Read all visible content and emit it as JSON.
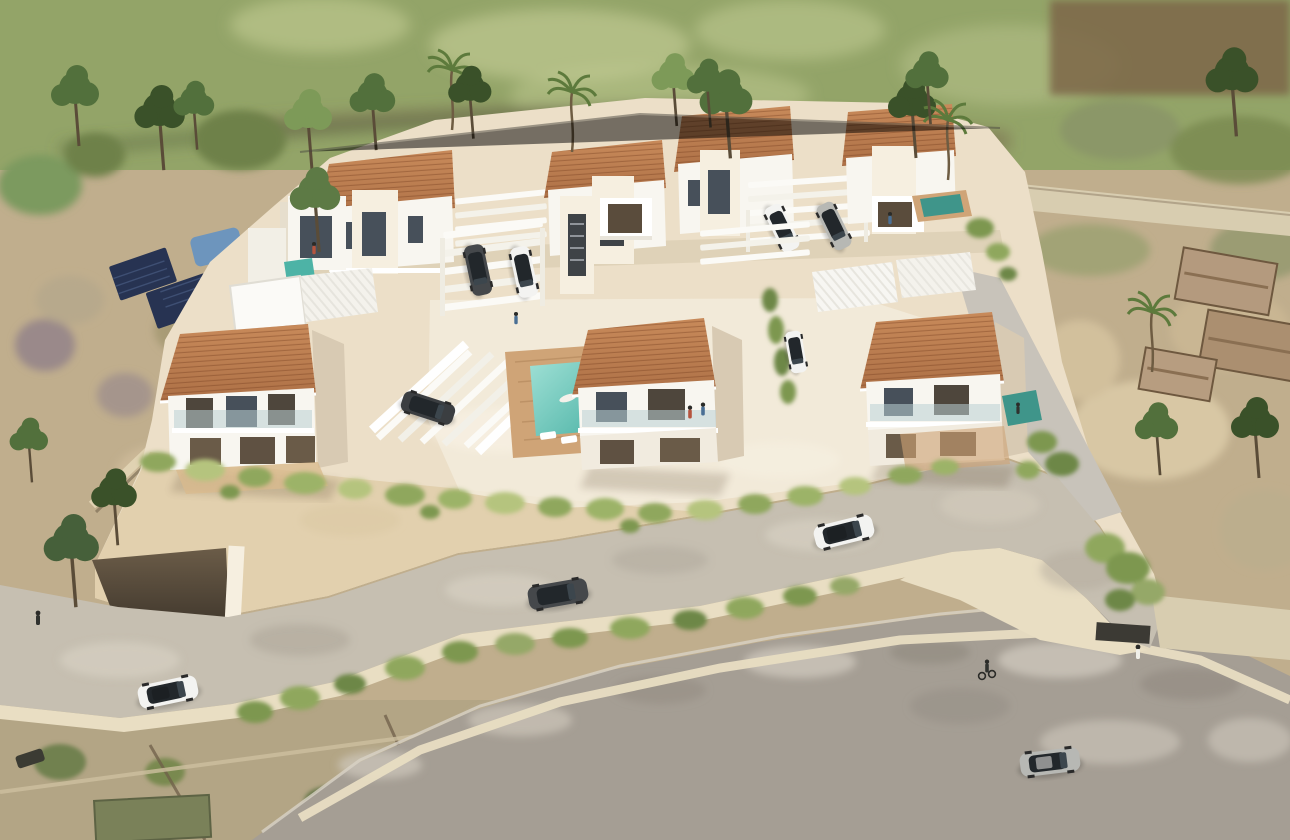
{
  "scene": {
    "title": "Aerial 3D architectural render of a gated villa development",
    "setting": "hillside plot bordered by trees, an access road and aerial-photo countryside",
    "view": "high-angle bird's-eye perspective"
  },
  "colors": {
    "meadow": "#93a468",
    "meadow_light": "#c6cf97",
    "scrub_brown": "#7a6a51",
    "terrain_tan": "#c0ae8d",
    "terrain_light": "#dac9a6",
    "terrain_green": "#79894f",
    "terrain_dark_green": "#48583a",
    "terrain_purple": "#90808a",
    "plot_cream": "#ecdfc8",
    "plot_light": "#f3ecdc",
    "wall_cream": "#e2d0ae",
    "wall_bright": "#f6efe0",
    "road_asphalt": "#a59e94",
    "road_light": "#cfc8bc",
    "driveway": "#c6bfb1",
    "gravel": "#d8cdb0",
    "curb": "#e9dec3",
    "roof_terracotta": "#ad7046",
    "roof_light": "#c88a5a",
    "roof_dark": "#8f5d38",
    "white_wall": "#f8f6f0",
    "white_shadow": "#e3dbca",
    "side_shadow": "#d8cab3",
    "glass_dark": "#47505a",
    "opening_warm": "#5f5142",
    "balcony_glass": "#b9cfd4",
    "pool_turquoise": "#7bd0c4",
    "pool_deep": "#4db3a6",
    "pool_small": "#3f958a",
    "neighbor_pool": "#6d95bd",
    "murky_pool": "#7a8159",
    "deck_wood": "#cfa477",
    "vine_green": "#8fa75d",
    "vine_light": "#b5c47e",
    "hedge_green": "#7d974f",
    "tree_green": "#52703c",
    "tree_dark": "#3a5129",
    "tree_light": "#7d9a58",
    "trunk": "#5a4c38",
    "solar_panel": "#273352",
    "car_white": "#f3f3f1",
    "car_dark": "#45484b",
    "car_silver": "#b7b8b4",
    "car_glass": "#22272b",
    "person_dark": "#30322f",
    "person_red": "#b5543e",
    "person_blue": "#4a6f94"
  },
  "objects": {
    "villas": {
      "front_row": 3,
      "middle_cluster": 4,
      "back_row": 4,
      "roof_styles": "terracotta gable roofs and white flat roofs with slatted pergolas"
    },
    "pools": [
      {
        "name": "central-courtyard-pool",
        "color_key": "pool_turquoise",
        "feature": "swimmer on float"
      },
      {
        "name": "front-right-villa-pool",
        "color_key": "pool_small"
      },
      {
        "name": "back-right-villa-pool",
        "color_key": "pool_small"
      },
      {
        "name": "middle-left-villa-pool",
        "color_key": "pool_deep"
      },
      {
        "name": "neighbor-pool-left",
        "color_key": "neighbor_pool"
      },
      {
        "name": "neighbor-pond-bottom",
        "color_key": "murky_pool"
      }
    ],
    "vehicles": [
      {
        "name": "white-sedan-access-road",
        "color_key": "car_white"
      },
      {
        "name": "dark-hatchback-access-road",
        "color_key": "car_dark"
      },
      {
        "name": "white-suv-driveway-bend",
        "color_key": "car_white"
      },
      {
        "name": "silver-car-lower-road",
        "color_key": "car_silver"
      },
      {
        "name": "dark-suv-carport-center",
        "color_key": "car_dark"
      },
      {
        "name": "white-car-carport-center",
        "color_key": "car_white"
      },
      {
        "name": "white-car-carport-right",
        "color_key": "car_white"
      },
      {
        "name": "silver-car-carport-right",
        "color_key": "car_silver"
      }
    ],
    "people": [
      "couple on centre-villa balcony",
      "swimmer floating in courtyard pool",
      "person beside the pool loungers",
      "pedestrian at the site exit",
      "cyclist on the driveway bend",
      "walker on the left road"
    ],
    "infrastructure": [
      "perimeter retaining wall with cascading vines",
      "underground garage entrance",
      "white slatted carport pergolas",
      "solar panels on neighbouring plot",
      "stone ruins on right-hand plot"
    ]
  }
}
